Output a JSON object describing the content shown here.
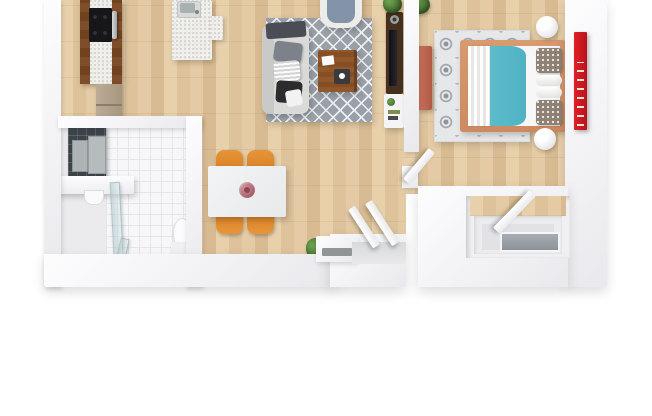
{
  "meta": {
    "kind": "3d-floor-plan-top-view",
    "description": "Top-down 3D rendered floor plan of a one-bedroom apartment on a white background",
    "background": "#ffffff"
  },
  "palette": {
    "wood_floor": "#e0c49c",
    "cabinet_wood_dark": "#7a4a28",
    "wall_white": "#f3f3f6",
    "living_rug_gray": "#99a0a8",
    "rug_pattern_white": "#eef0f2",
    "sofa_gray": "#d6d6d4",
    "coffee_table_brown": "#8a5128",
    "dining_chair_orange": "#e08a2e",
    "dining_table_white": "#eef0f1",
    "duvet_teal": "#57b9c8",
    "bed_frame_terracotta": "#d2916c",
    "wall_shelf_red": "#d2151e",
    "fridge_bronze": "#b2a18b",
    "cooktop_black": "#17171a",
    "bathroom_tile_dark": "#3d4449",
    "bathroom_tile_light": "#f7f7f9",
    "bedroom_bench_salmon": "#c26b56",
    "plant_green": "#4f7d39",
    "tv_console_brown": "#45301f",
    "shower_glass": "#b8ccd0"
  },
  "rooms": [
    {
      "id": "kitchen",
      "label": "Kitchen"
    },
    {
      "id": "living_dining",
      "label": "Living / Dining room"
    },
    {
      "id": "bathroom",
      "label": "Bathroom"
    },
    {
      "id": "bedroom",
      "label": "Bedroom"
    },
    {
      "id": "entry",
      "label": "Entry"
    },
    {
      "id": "closet",
      "label": "Closet / window alcove"
    }
  ],
  "items": {
    "sofa": "Gray sofa with cushions",
    "living_rug": "Gray diamond-pattern rug",
    "coffee_table": "Wooden coffee table",
    "armchair": "Armchair with blue cushion",
    "tv_console": "TV console",
    "media_cabinet": "White media cabinet",
    "dining_table": "White dining table",
    "dining_chair": "Orange dining chair",
    "flower": "Flower centerpiece",
    "plant": "Potted plant",
    "island": "Kitchen island with sink",
    "sink": "Stainless sink",
    "counter": "Kitchen counter",
    "cooktop": "Black cooktop with oven",
    "fridge": "Refrigerator",
    "vanity": "Bathroom vanity",
    "mirror_cabinet": "Mirror cabinet",
    "shower": "Glass shower",
    "toilet": "Toilet",
    "bed": "Double bed with teal duvet",
    "bedroom_rug": "Gray ikat-pattern rug",
    "pendant_lamp": "White bedside lamp",
    "bedroom_bench": "Salmon bench",
    "red_shelf": "Red wall shelf with books",
    "door": "Open door",
    "threshold": "Entry threshold",
    "window_alcove": "Window alcove"
  }
}
